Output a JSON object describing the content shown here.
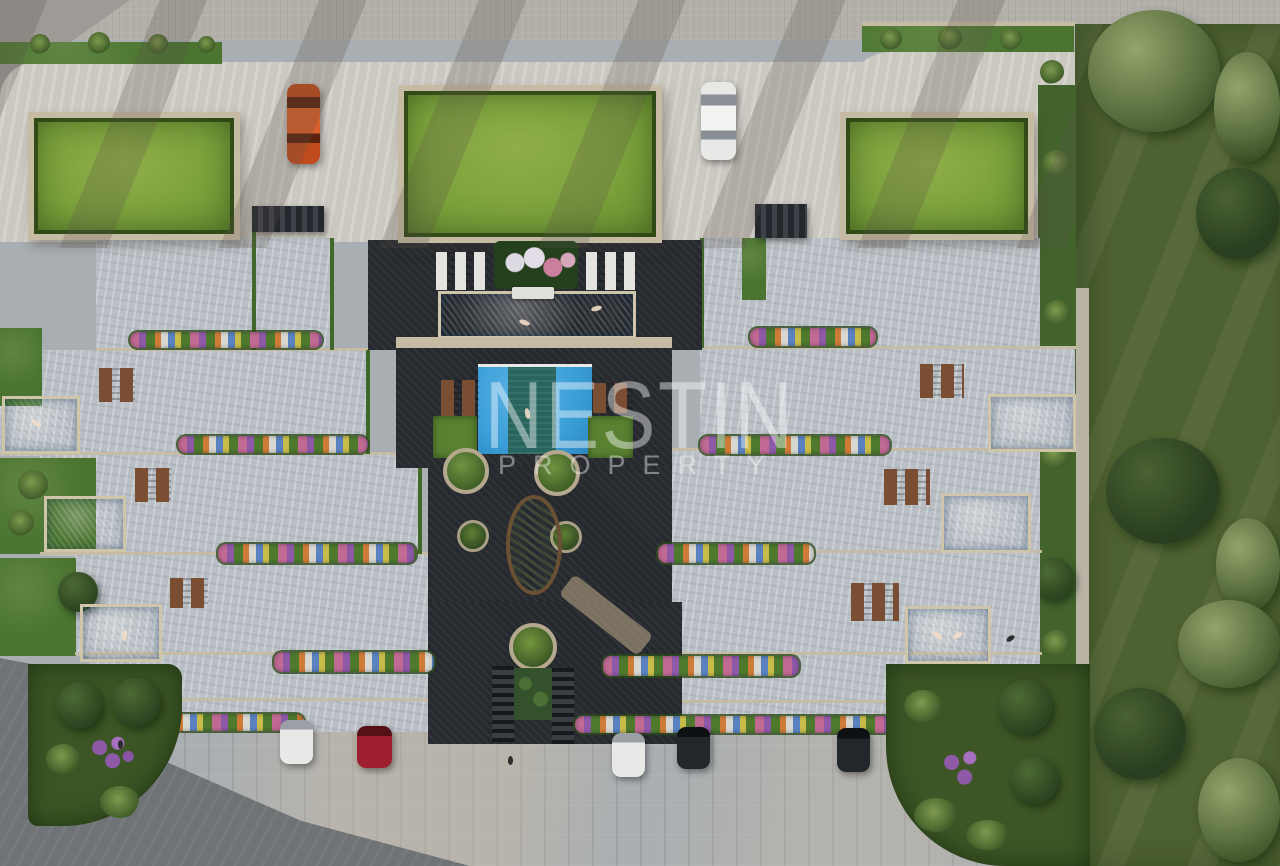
{
  "meta": {
    "scene": "Aerial top-down 3D architectural rendering of a residential complex with green roofs, communal courtyard pools, private terrace pools, gardens and parked cars",
    "canvas": {
      "width": 1280,
      "height": 866
    }
  },
  "watermark": {
    "line1": "NESTIN",
    "line2": "PROPERTY"
  },
  "palette": {
    "sidewalk": "#b3b0aa",
    "road-corner": "#9e9a96",
    "road-dark": "#707376",
    "plaza": "#cbc8c1",
    "terrace": "#b9bfc5",
    "wall-tan": "#c6bca4",
    "paving-dark": "#26292e",
    "hedge": "#41682b",
    "grass-strip": "#4a7430",
    "roof-grass": "#7ca23c",
    "lawn": "#4e6130",
    "tree-dark": "#2a3f1f",
    "tree-light": "#93a56b",
    "pool-blue": "#3b9ed8",
    "pool-deep": "#2b85bf",
    "pool-teal": "#27655e",
    "pool-rim": "#cfc5ab",
    "flower-green": "#3c5a26",
    "f-pink": "#c06a94",
    "f-purple": "#8e5aa8",
    "f-orange": "#cf7c39",
    "f-white": "#d8d8d2",
    "f-blue": "#5b82c0",
    "f-yellow": "#c9bc4a",
    "f-green": "#4f7a2e",
    "lounger-brown": "#7a4e33",
    "lounger-white": "#e4e3df",
    "car-orange": "#bf4b1d",
    "car-white": "#e8e8e6",
    "car-red": "#9e2030",
    "car-dark": "#23272c",
    "pavement": "#a9aeb2",
    "watermark": "rgba(255,255,255,0.33)"
  },
  "inventory": {
    "green_roofs": 3,
    "communal_pools": 2,
    "private_terrace_pools": 6,
    "parked_cars_top": 2,
    "parked_cars_bottom": 5,
    "white_lounger_groups": 2,
    "brown_lounger_groups": 8,
    "flower_beds": 10,
    "corner_gardens": 2,
    "stair_flights": 2,
    "round_planters": 5
  }
}
